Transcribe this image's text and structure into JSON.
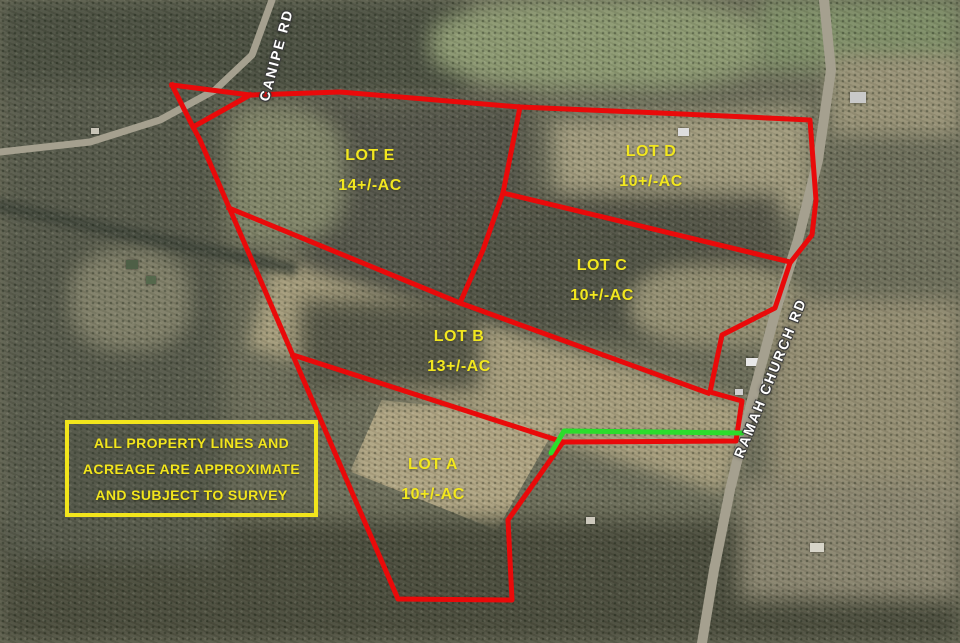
{
  "map": {
    "title": "Aerial property lot map",
    "roads": {
      "canipe": {
        "label": "CANIPE RD"
      },
      "ramah": {
        "label": "RAMAH CHURCH RD"
      }
    },
    "disclaimer": {
      "line1": "ALL PROPERTY LINES AND",
      "line2": "ACREAGE ARE APPROXIMATE",
      "line3": "AND SUBJECT TO SURVEY"
    },
    "lots": [
      {
        "name": "LOT E",
        "acreage": "14+/-AC",
        "x": 370,
        "y": 171
      },
      {
        "name": "LOT D",
        "acreage": "10+/-AC",
        "x": 651,
        "y": 167
      },
      {
        "name": "LOT C",
        "acreage": "10+/-AC",
        "x": 602,
        "y": 281
      },
      {
        "name": "LOT B",
        "acreage": "13+/-AC",
        "x": 459,
        "y": 352
      },
      {
        "name": "LOT A",
        "acreage": "10+/-AC",
        "x": 433,
        "y": 480
      }
    ],
    "colors": {
      "boundary": "#e90a0a",
      "highlight": "#2cdc2c",
      "lot_label": "#f2e71f",
      "disclaimer_text": "#f2e51c",
      "disclaimer_border": "#f2e51c",
      "road_label": "#ffffff",
      "road_fill": "#a5a08f"
    },
    "geometry": {
      "stroke_width": 5,
      "red_lines": {
        "outer_boundary": [
          [
            250,
            95
          ],
          [
            340,
            92
          ],
          [
            520,
            107
          ],
          [
            660,
            113
          ],
          [
            810,
            120
          ],
          [
            816,
            200
          ],
          [
            812,
            235
          ],
          [
            790,
            263
          ],
          [
            775,
            308
          ],
          [
            722,
            335
          ],
          [
            710,
            392
          ],
          [
            742,
            401
          ],
          [
            736,
            441
          ],
          [
            563,
            442
          ],
          [
            508,
            520
          ],
          [
            512,
            600
          ],
          [
            398,
            599
          ],
          [
            200,
            140
          ],
          [
            193,
            127
          ],
          [
            250,
            95
          ]
        ],
        "canipe_triangle": [
          [
            172,
            85
          ],
          [
            250,
            95
          ],
          [
            193,
            127
          ],
          [
            172,
            85
          ]
        ],
        "divider_e_d": [
          [
            520,
            107
          ],
          [
            503,
            193
          ]
        ],
        "divider_d_c": [
          [
            503,
            193
          ],
          [
            790,
            262
          ]
        ],
        "divider_e_c": [
          [
            503,
            193
          ],
          [
            483,
            250
          ],
          [
            460,
            303
          ]
        ],
        "divider_e_b": [
          [
            229,
            208
          ],
          [
            460,
            303
          ]
        ],
        "divider_b_c": [
          [
            460,
            303
          ],
          [
            708,
            393
          ]
        ],
        "divider_a_b": [
          [
            293,
            355
          ],
          [
            563,
            442
          ]
        ]
      },
      "green_line": [
        [
          551,
          453
        ],
        [
          564,
          431
        ],
        [
          742,
          433
        ]
      ]
    },
    "road_paths": {
      "canipe": {
        "width": 7,
        "points": [
          [
            272,
            0
          ],
          [
            252,
            55
          ],
          [
            215,
            90
          ],
          [
            160,
            120
          ],
          [
            90,
            142
          ],
          [
            0,
            152
          ]
        ]
      },
      "ramah": {
        "width": 10,
        "points": [
          [
            824,
            0
          ],
          [
            831,
            70
          ],
          [
            818,
            160
          ],
          [
            798,
            240
          ],
          [
            776,
            310
          ],
          [
            752,
            400
          ],
          [
            730,
            490
          ],
          [
            714,
            570
          ],
          [
            702,
            643
          ]
        ]
      }
    }
  }
}
